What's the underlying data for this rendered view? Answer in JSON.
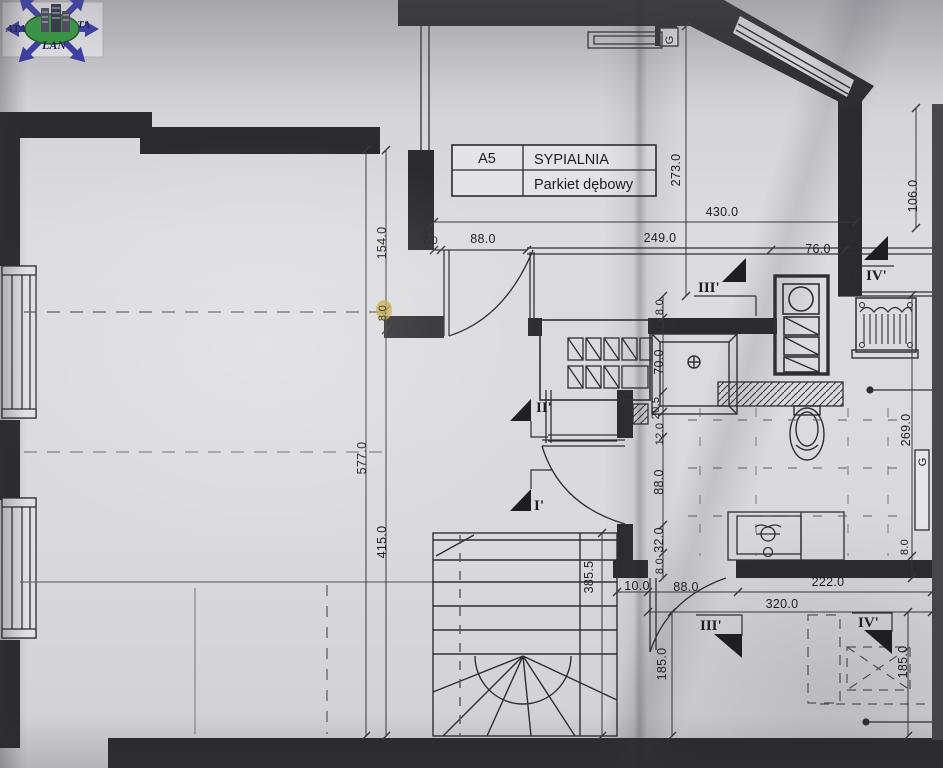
{
  "document": {
    "type": "architectural floor plan photo",
    "room_label": {
      "code": "A5",
      "name": "SYPIALNIA",
      "floor": "Parkiet dębowy"
    }
  },
  "logo": {
    "left": "ATA",
    "right": "TA",
    "bottom": "LAN"
  },
  "labels": {
    "duct_top": "G",
    "duct_right": "G"
  },
  "markers": {
    "s1": "I'",
    "s2": "II'",
    "s3_top": "III'",
    "s4_top": "IV'",
    "s3_bottom": "III'",
    "s4_bottom": "IV'"
  },
  "dims": {
    "total_width": "430.0",
    "seg_7": "7.0",
    "seg_88_top": "88.0",
    "seg_249": "249.0",
    "seg_76": "76.0",
    "bedroom_height": "273.0",
    "alcove_depth": "106.0",
    "left_total": "577.0",
    "left_top": "154.0",
    "left_wall": "8.0",
    "left_bottom": "415.0",
    "bath_top_wall": "8.0",
    "shower": "70.0",
    "niche_205": "20.5",
    "niche_12": "12.0",
    "bath_door": "88.0",
    "seg_32": "32.0",
    "bath_wall": "8.0",
    "stairs": "385.5",
    "bottom_10": "10.0",
    "bottom_door": "88.0",
    "bottom_222": "222.0",
    "bottom_total": "320.0",
    "roomb_left": "185.0",
    "roomb_right": "185.0",
    "bath_right": "269.0",
    "right_wall": "8.0"
  },
  "colors": {
    "wall": "#2b2b2e",
    "logo_blue": "#3437ad",
    "logo_green": "#2f9e3c",
    "highlight": "#c9a83f",
    "paper": "#d8d8dc"
  }
}
